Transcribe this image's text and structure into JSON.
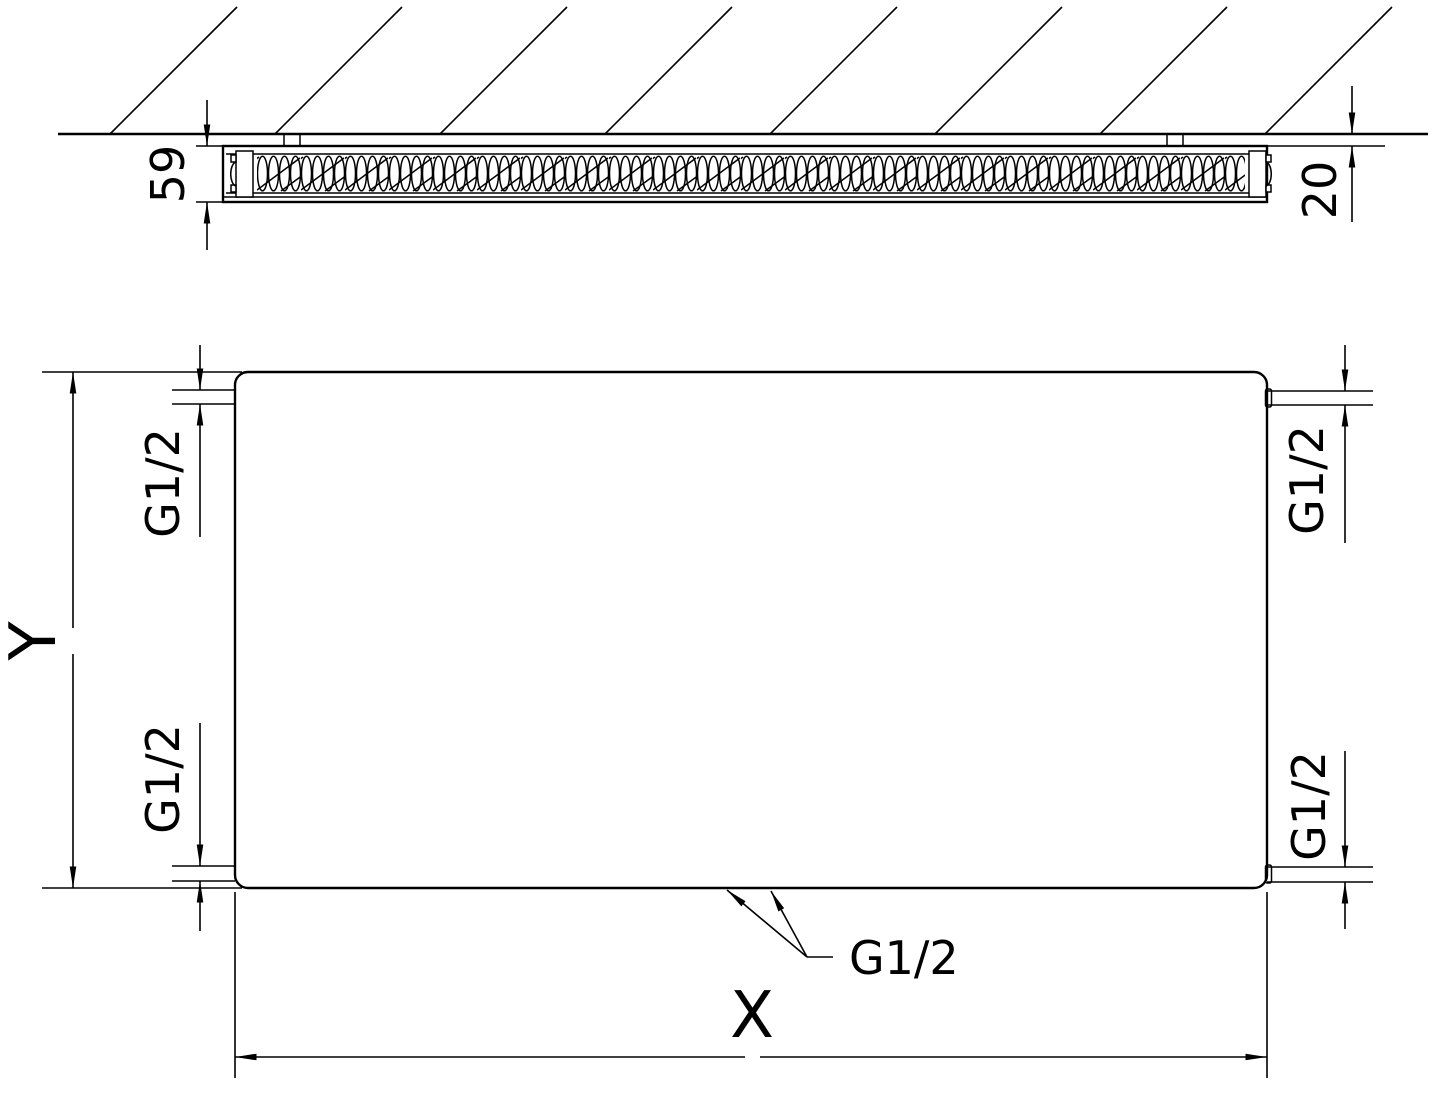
{
  "section_view": {
    "depth_dim": "59",
    "wall_gap_dim": "20"
  },
  "front_view": {
    "height_dim": "Y",
    "width_dim": "X",
    "thread_top_left": "G1/2",
    "thread_top_right": "G1/2",
    "thread_bottom_left": "G1/2",
    "thread_bottom_right": "G1/2",
    "thread_bottom_center": "G1/2"
  },
  "colors": {
    "line_color": "#000000",
    "background": "#ffffff"
  }
}
